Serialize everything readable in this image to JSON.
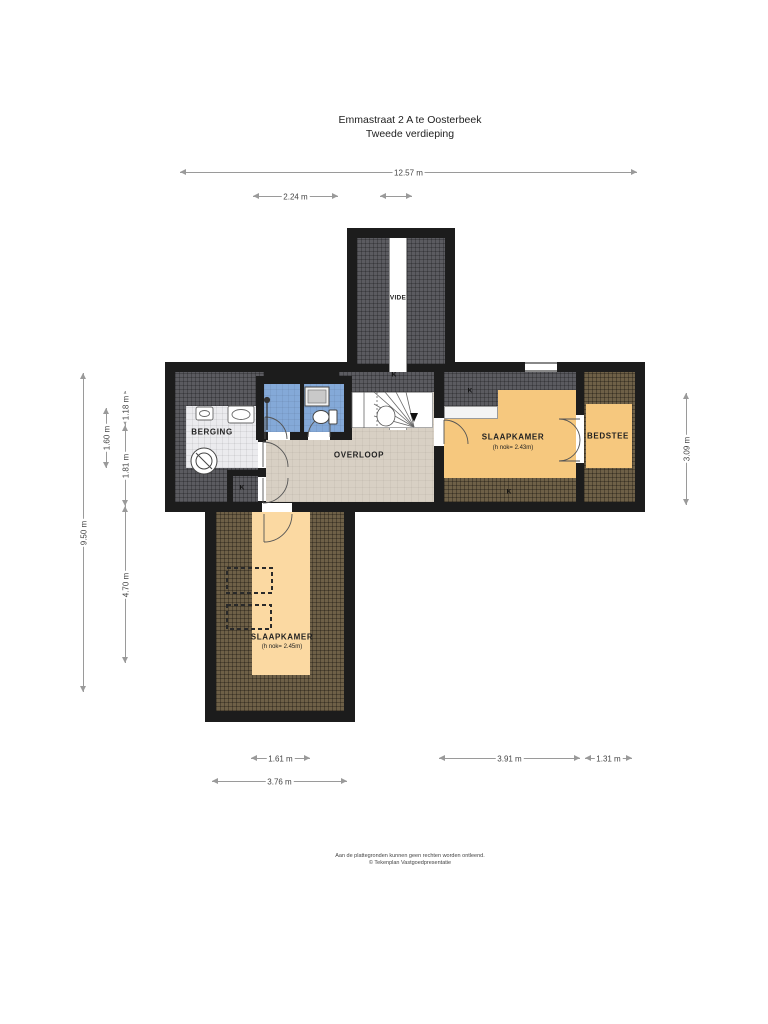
{
  "title": {
    "line1": "Emmastraat 2 A te Oosterbeek",
    "line2": "Tweede verdieping"
  },
  "rooms": {
    "vide": "VIDE",
    "berging": "BERGING",
    "overloop": "OVERLOOP",
    "slaapkamer_right": {
      "name": "SLAAPKAMER",
      "sub": "(h nok= 2.43m)"
    },
    "bedstee": "BEDSTEE",
    "slaapkamer_bottom": {
      "name": "SLAAPKAMER",
      "sub": "(h nok= 2.45m)"
    },
    "knee_wall_marker": "K"
  },
  "dimensions": {
    "top_width": "12.57 m",
    "top_left_segment": "2.24 m",
    "left_total": "9.50 m",
    "left_seg_a": "1.18 m",
    "left_seg_b": "1.60 m",
    "left_seg_c": "1.81 m",
    "left_seg_d": "4.70 m",
    "right_height": "3.09 m",
    "bottom_seg_a": "1.61 m",
    "bottom_seg_b": "3.91 m",
    "bottom_seg_c": "1.31 m",
    "bottom_total": "3.76 m"
  },
  "footer": {
    "line1": "Aan de plattegronden kunnen geen rechten worden ontleend.",
    "line2": "© Tekenplan Vastgoedpresentatie"
  },
  "colors": {
    "wall": "#1c1c1c",
    "sloped_low_gray": "#5b5b60",
    "sloped_low_brown": "#6e6047",
    "floor_landing": "#d8d0c4",
    "floor_bedroom": "#f6c87e",
    "floor_bedroom_light": "#fbd9a2",
    "bathroom_blue": "#84a9d8",
    "storage_floor": "#ebebee"
  }
}
